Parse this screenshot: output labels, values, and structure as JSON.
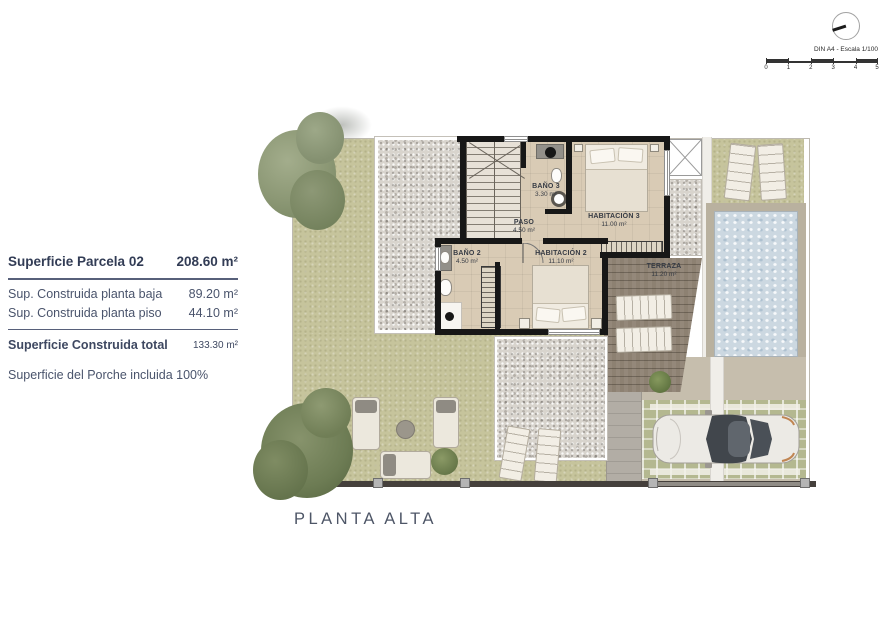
{
  "sheet": {
    "scale_label": "DIN A4 - Escala 1/100",
    "scale_ticks": [
      "0",
      "1",
      "2",
      "3",
      "4",
      "5"
    ],
    "plan_title": "PLANTA ALTA"
  },
  "info_panel": {
    "parcel": {
      "label": "Superficie Parcela 02",
      "value": "208.60 m²"
    },
    "rows": [
      {
        "label": "Sup. Construida planta baja",
        "value": "89.20 m²"
      },
      {
        "label": "Sup. Construida planta piso",
        "value": "44.10 m²"
      }
    ],
    "total": {
      "label": "Superficie Construida total",
      "value": "133.30 m²"
    },
    "note": "Superficie del Porche incluida 100%"
  },
  "rooms": {
    "bano3": {
      "name": "BAÑO 3",
      "area": "3.30 m²"
    },
    "paso": {
      "name": "PASO",
      "area": "4.50 m²"
    },
    "habitacion3": {
      "name": "HABITACIÓN 3",
      "area": "11.00 m²"
    },
    "bano2": {
      "name": "BAÑO 2",
      "area": "4.50 m²"
    },
    "habitacion2": {
      "name": "HABITACIÓN 2",
      "area": "11.10 m²"
    },
    "terraza": {
      "name": "TERRAZA",
      "area": "11.20 m²"
    }
  },
  "colors": {
    "lawn": "#c6c49c",
    "gravel": "#d8d4cd",
    "floor": "#d9cbb5",
    "deck": "#8d8172",
    "pool": "#ccd8e1",
    "wall": "#171717",
    "ink": "#49536b",
    "fence": "#45403c"
  }
}
